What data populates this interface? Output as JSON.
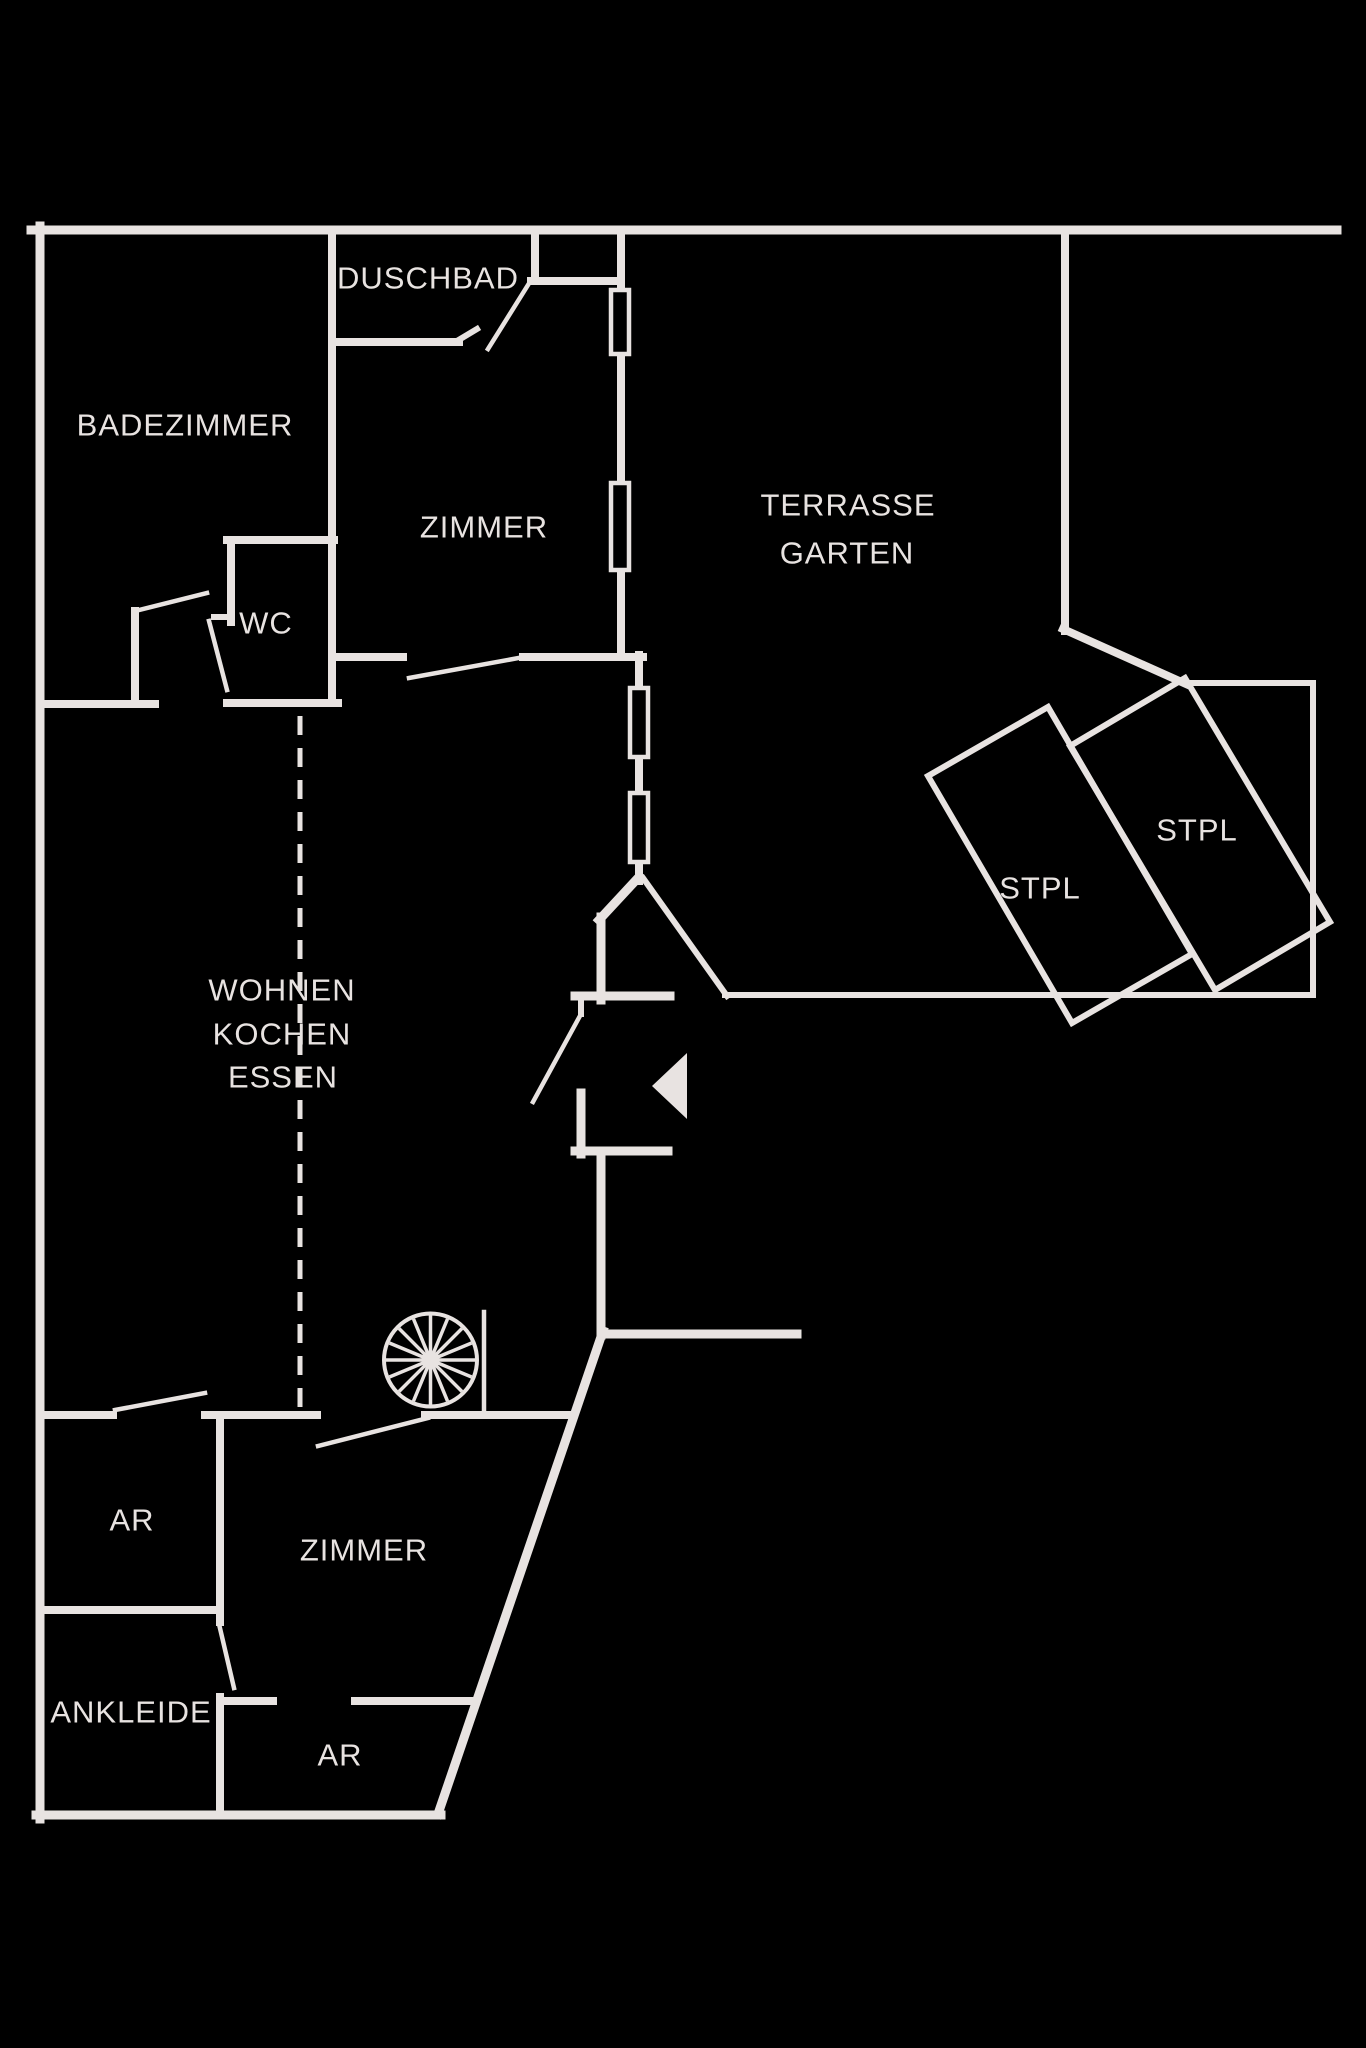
{
  "plan": {
    "colors": {
      "bg": "#000000",
      "ink": "#e8e3e1"
    },
    "stroke": {
      "outer": 9,
      "inner": 8,
      "site": 6,
      "thin": 4.5,
      "window": 4.5,
      "dash": 5
    },
    "segments": {
      "outer": [
        [
          "north-outer-wall",
          31,
          230,
          1337,
          230
        ],
        [
          "west-outer-wall",
          40,
          226,
          40,
          1819
        ],
        [
          "south-outer-wall",
          36,
          1815,
          441,
          1815
        ],
        [
          "southeast-diagonal-wall",
          438,
          1814,
          603,
          1331
        ],
        [
          "site-boundary-south",
          601,
          1334,
          797,
          1334
        ],
        [
          "entry-wall-vertical-upper",
          601,
          917,
          601,
          1000
        ],
        [
          "entry-v-left-wall",
          638,
          878,
          599,
          920
        ],
        [
          "entry-wall-horizontal-upper",
          575,
          996,
          670,
          996
        ],
        [
          "entry-wall-left",
          581,
          1093,
          581,
          1154
        ],
        [
          "entry-wall-horizontal-lower",
          575,
          1151,
          668,
          1151
        ],
        [
          "entry-wall-vertical-lower",
          601,
          1151,
          601,
          1335
        ]
      ],
      "inner": [
        [
          "badezimmer-east-wall",
          332,
          234,
          332,
          703
        ],
        [
          "niche-west-wall",
          535,
          234,
          535,
          281
        ],
        [
          "niche-south-wall",
          531,
          281,
          618,
          281
        ],
        [
          "east-wall-a",
          621,
          234,
          621,
          292
        ],
        [
          "east-wall-b",
          621,
          351,
          621,
          485
        ],
        [
          "east-wall-c",
          621,
          568,
          621,
          657
        ],
        [
          "zimmer-south-wall-right",
          523,
          657,
          643,
          657
        ],
        [
          "zimmer-south-wall-left",
          337,
          657,
          403,
          657
        ],
        [
          "east-wall-d",
          639,
          655,
          639,
          690
        ],
        [
          "east-wall-e",
          639,
          755,
          639,
          795
        ],
        [
          "east-wall-f",
          639,
          860,
          639,
          881
        ],
        [
          "wc-north-wall",
          227,
          540,
          334,
          540
        ],
        [
          "wc-west-wall",
          231,
          544,
          231,
          622
        ],
        [
          "wc-south-wall",
          227,
          703,
          338,
          703
        ],
        [
          "badezimmer-south-wall",
          40,
          704,
          155,
          704
        ],
        [
          "badezimmer-door-stub",
          135,
          611,
          135,
          704
        ],
        [
          "duschbad-south-wall",
          337,
          342,
          459,
          342
        ],
        [
          "ar-north-wall-a",
          44,
          1415,
          113,
          1415
        ],
        [
          "ar-north-wall-b",
          205,
          1415,
          317,
          1415
        ],
        [
          "zimmer2-north-wall",
          425,
          1415,
          570,
          1415
        ],
        [
          "ar-east-wall",
          220,
          1415,
          220,
          1622
        ],
        [
          "ar-south-wall",
          44,
          1610,
          220,
          1610
        ],
        [
          "ankleide-east-wall",
          220,
          1697,
          220,
          1815
        ],
        [
          "ankleide-south-wall-a",
          220,
          1701,
          273,
          1701
        ],
        [
          "ankleide-south-wall-b",
          355,
          1701,
          471,
          1701
        ],
        [
          "terrace-fence-west",
          1065,
          234,
          1065,
          631
        ],
        [
          "terrace-fence-diagonal",
          1063,
          629,
          1186,
          684
        ]
      ],
      "site": [
        [
          "garden-boundary-north",
          1185,
          683,
          1313,
          683
        ],
        [
          "garden-boundary-east",
          1313,
          683,
          1313,
          995
        ],
        [
          "garden-boundary-south",
          725,
          995,
          1313,
          995
        ],
        [
          "entry-v-right-fence",
          643,
          878,
          727,
          996
        ],
        [
          "duschbad-door-cap",
          457,
          341,
          477,
          329
        ],
        [
          "wc-door-tick",
          214,
          617,
          232,
          617
        ],
        [
          "entry-door-stub",
          581,
          996,
          581,
          1014
        ]
      ],
      "thin": [
        [
          "duschbad-door-leaf",
          488,
          349,
          528,
          285
        ],
        [
          "zimmer-door-leaf",
          409,
          678,
          524,
          657
        ],
        [
          "badezimmer-door-leaf",
          135,
          611,
          207,
          593
        ],
        [
          "wc-door-leaf",
          209,
          621,
          227,
          690
        ],
        [
          "entry-door-leaf",
          533,
          1102,
          581,
          1014
        ],
        [
          "ar-door-leaf",
          115,
          1410,
          205,
          1393
        ],
        [
          "zimmer2-door-leaf",
          318,
          1446,
          428,
          1418
        ],
        [
          "ankleide-door-leaf",
          219,
          1624,
          234,
          1688
        ],
        [
          "stair-rail",
          484,
          1312,
          484,
          1415
        ]
      ]
    },
    "polygons": [
      {
        "id": "stpl-left-parking",
        "points": [
          [
            1048,
            707
          ],
          [
            928,
            776
          ],
          [
            1072,
            1023
          ],
          [
            1192,
            954
          ]
        ]
      },
      {
        "id": "stpl-right-parking",
        "points": [
          [
            1185,
            678
          ],
          [
            1070,
            746
          ],
          [
            1215,
            990
          ],
          [
            1330,
            922
          ]
        ]
      }
    ],
    "windows": [
      {
        "id": "window-1",
        "x": 611,
        "y": 290,
        "w": 18,
        "h": 64
      },
      {
        "id": "window-2",
        "x": 611,
        "y": 483,
        "w": 18,
        "h": 87
      },
      {
        "id": "window-3",
        "x": 630,
        "y": 688,
        "w": 18,
        "h": 69
      },
      {
        "id": "window-4",
        "x": 630,
        "y": 793,
        "w": 18,
        "h": 69
      }
    ],
    "dashed_line": {
      "id": "open-plan-divider",
      "x": 300,
      "y1": 716,
      "y2": 1408,
      "dash": 19,
      "gap": 13
    },
    "arrow": {
      "id": "entrance-arrow",
      "points": [
        [
          652,
          1086
        ],
        [
          687,
          1053
        ],
        [
          687,
          1119
        ]
      ]
    },
    "spiral_stair": {
      "cx": 430.5,
      "cy": 1360,
      "r": 46.5,
      "hub_r": 9,
      "spokes": 16
    },
    "labels": [
      {
        "id": "duschbad",
        "text": "DUSCHBAD",
        "x": 428,
        "y": 278,
        "size": 31
      },
      {
        "id": "badezimmer",
        "text": "BADEZIMMER",
        "x": 185,
        "y": 425,
        "size": 31
      },
      {
        "id": "zimmer-top",
        "text": "ZIMMER",
        "x": 484,
        "y": 527,
        "size": 31
      },
      {
        "id": "terrasse",
        "text": "TERRASSE",
        "x": 848,
        "y": 505,
        "size": 31
      },
      {
        "id": "garten",
        "text": "GARTEN",
        "x": 847,
        "y": 553,
        "size": 31
      },
      {
        "id": "wc",
        "text": "WC",
        "x": 266,
        "y": 623,
        "size": 31
      },
      {
        "id": "stpl-left",
        "text": "STPL",
        "x": 1040,
        "y": 888,
        "size": 31
      },
      {
        "id": "stpl-right",
        "text": "STPL",
        "x": 1197,
        "y": 830,
        "size": 31
      },
      {
        "id": "wohnen",
        "text": "WOHNEN",
        "x": 282,
        "y": 990,
        "size": 31
      },
      {
        "id": "kochen",
        "text": "KOCHEN",
        "x": 282,
        "y": 1034,
        "size": 31
      },
      {
        "id": "essen",
        "text": "ESSEN",
        "x": 283,
        "y": 1077,
        "size": 31
      },
      {
        "id": "ar-top",
        "text": "AR",
        "x": 132,
        "y": 1520,
        "size": 31
      },
      {
        "id": "zimmer-bottom",
        "text": "ZIMMER",
        "x": 364,
        "y": 1550,
        "size": 31
      },
      {
        "id": "ankleide",
        "text": "ANKLEIDE",
        "x": 131,
        "y": 1712,
        "size": 31
      },
      {
        "id": "ar-bottom",
        "text": "AR",
        "x": 340,
        "y": 1755,
        "size": 31
      }
    ]
  }
}
